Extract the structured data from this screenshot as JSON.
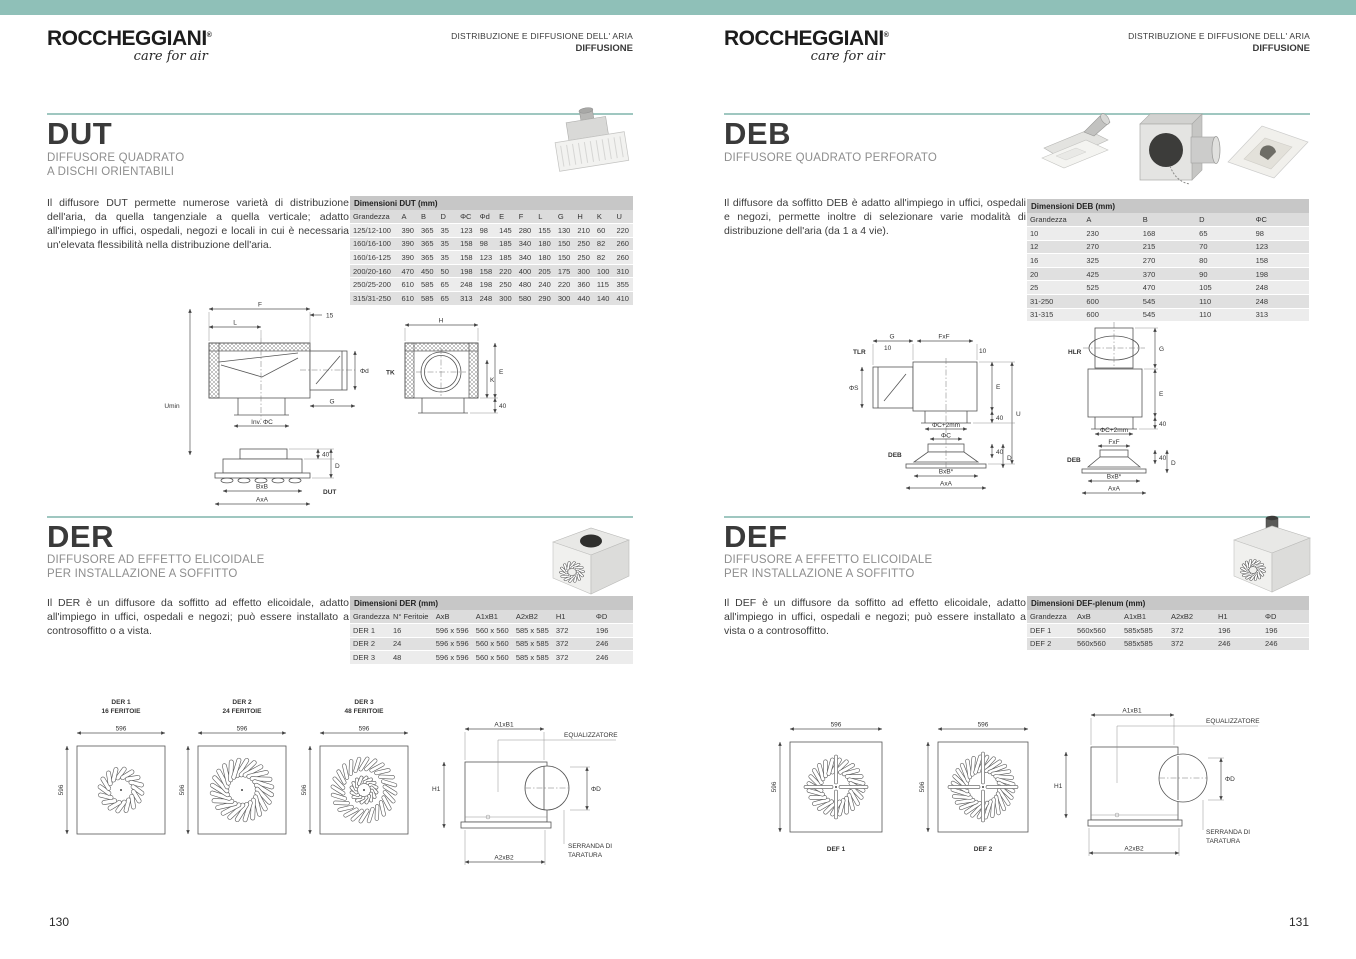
{
  "accent": {
    "band": "#8fc0b8",
    "divider": "#9fc7c0"
  },
  "header": {
    "brand": "ROCCHEGGIANI",
    "reg": "®",
    "tagline": "care for air",
    "line1": "DISTRIBUZIONE E DIFFUSIONE DELL' ARIA",
    "line2": "DIFFUSIONE"
  },
  "pages": {
    "left_number": "130",
    "right_number": "131"
  },
  "dut": {
    "title": "DUT",
    "subtitle1": "DIFFUSORE QUADRATO",
    "subtitle2": "A DISCHI ORIENTABILI",
    "description": "Il diffusore DUT permette numerose varietà di distribuzione dell'aria, da quella tangenziale a quella verticale; adatto all'impiego in uffici, ospedali, negozi e locali in cui è necessaria un'elevata flessibilità nella distribuzione dell'aria.",
    "table": {
      "title": "Dimensioni DUT (mm)",
      "columns": [
        "Grandezza",
        "A",
        "B",
        "D",
        "ΦC",
        "Φd",
        "E",
        "F",
        "L",
        "G",
        "H",
        "K",
        "U"
      ],
      "rows": [
        [
          "125/12-100",
          "390",
          "365",
          "35",
          "123",
          "98",
          "145",
          "280",
          "155",
          "130",
          "210",
          "60",
          "220"
        ],
        [
          "160/16-100",
          "390",
          "365",
          "35",
          "158",
          "98",
          "185",
          "340",
          "180",
          "150",
          "250",
          "82",
          "260"
        ],
        [
          "160/16-125",
          "390",
          "365",
          "35",
          "158",
          "123",
          "185",
          "340",
          "180",
          "150",
          "250",
          "82",
          "260"
        ],
        [
          "200/20-160",
          "470",
          "450",
          "50",
          "198",
          "158",
          "220",
          "400",
          "205",
          "175",
          "300",
          "100",
          "310"
        ],
        [
          "250/25-200",
          "610",
          "585",
          "65",
          "248",
          "198",
          "250",
          "480",
          "240",
          "220",
          "360",
          "115",
          "355"
        ],
        [
          "315/31-250",
          "610",
          "585",
          "65",
          "313",
          "248",
          "300",
          "580",
          "290",
          "300",
          "440",
          "140",
          "410"
        ]
      ]
    },
    "diagram": {
      "f": "F",
      "l": "L",
      "n15": "15",
      "umin": "Umin",
      "phid": "Φd",
      "g": "G",
      "inv": "Inv. ΦC",
      "h": "H",
      "tk": "TK",
      "e": "E",
      "k": "K",
      "n40": "40",
      "d": "D",
      "bxb": "BxB",
      "axa": "AxA",
      "name": "DUT"
    }
  },
  "deb": {
    "title": "DEB",
    "subtitle1": "DIFFUSORE QUADRATO PERFORATO",
    "description": "Il diffusore da soffitto DEB è adatto all'impiego in uffici, ospedali e negozi, permette inoltre di selezionare varie modalità di distribuzione dell'aria (da 1 a 4 vie).",
    "table": {
      "title": "Dimensioni DEB (mm)",
      "columns": [
        "Grandezza",
        "A",
        "B",
        "D",
        "ΦC"
      ],
      "rows": [
        [
          "10",
          "230",
          "168",
          "65",
          "98"
        ],
        [
          "12",
          "270",
          "215",
          "70",
          "123"
        ],
        [
          "16",
          "325",
          "270",
          "80",
          "158"
        ],
        [
          "20",
          "425",
          "370",
          "90",
          "198"
        ],
        [
          "25",
          "525",
          "470",
          "105",
          "248"
        ],
        [
          "31-250",
          "600",
          "545",
          "110",
          "248"
        ],
        [
          "31-315",
          "600",
          "545",
          "110",
          "313"
        ]
      ]
    },
    "diagram": {
      "tlr": "TLR",
      "hlr": "HLR",
      "g": "G",
      "n10": "10",
      "fxf": "FxF",
      "phis": "ΦS",
      "e": "E",
      "n40": "40",
      "u": "U",
      "phic2": "ΦC+2mm",
      "phic": "ΦC",
      "deb": "DEB",
      "d": "D",
      "bxb": "BxB*",
      "axa": "AxA"
    }
  },
  "der": {
    "title": "DER",
    "subtitle1": "DIFFUSORE AD EFFETTO ELICOIDALE",
    "subtitle2": "PER INSTALLAZIONE A SOFFITTO",
    "description": "Il DER è un diffusore da soffitto ad effetto elicoidale, adatto all'impiego in uffici, ospedali e negozi; può essere installato a controsoffitto o a vista.",
    "table": {
      "title": "Dimensioni DER (mm)",
      "columns": [
        "Grandezza",
        "N° Feritoie",
        "AxB",
        "A1xB1",
        "A2xB2",
        "H1",
        "ΦD"
      ],
      "rows": [
        [
          "DER 1",
          "16",
          "596 x 596",
          "560 x 560",
          "585 x 585",
          "372",
          "196"
        ],
        [
          "DER 2",
          "24",
          "596 x 596",
          "560 x 560",
          "585 x 585",
          "372",
          "246"
        ],
        [
          "DER 3",
          "48",
          "596 x 596",
          "560 x 560",
          "585 x 585",
          "372",
          "246"
        ]
      ]
    },
    "diagram": {
      "v1": "DER 1",
      "v1sub": "16 FERITOIE",
      "v2": "DER 2",
      "v2sub": "24 FERITOIE",
      "v3": "DER 3",
      "v3sub": "48 FERITOIE",
      "dim": "596",
      "h1": "H1",
      "a1b1": "A1xB1",
      "a2b2": "A2xB2",
      "phid": "ΦD",
      "eq": "EQUALIZZATORE",
      "ser1": "SERRANDA DI",
      "ser2": "TARATURA"
    }
  },
  "def": {
    "title": "DEF",
    "subtitle1": "DIFFUSORE A EFFETTO ELICOIDALE",
    "subtitle2": "PER INSTALLAZIONE A SOFFITTO",
    "description": "Il DEF è un diffusore da soffitto ad effetto elicoidale, adatto all'impiego in uffici, ospedali e negozi; può essere installato a vista o a controsoffitto.",
    "table": {
      "title": "Dimensioni DEF-plenum (mm)",
      "columns": [
        "Grandezza",
        "AxB",
        "A1xB1",
        "A2xB2",
        "H1",
        "ΦD"
      ],
      "rows": [
        [
          "DEF 1",
          "560x560",
          "585x585",
          "372",
          "196",
          "196"
        ],
        [
          "DEF 2",
          "560x560",
          "585x585",
          "372",
          "246",
          "246"
        ]
      ]
    },
    "diagram": {
      "v1": "DEF 1",
      "v2": "DEF 2",
      "dim": "596",
      "h1": "H1",
      "a1b1": "A1xB1",
      "a2b2": "A2xB2",
      "phid": "ΦD",
      "eq": "EQUALIZZATORE",
      "ser1": "SERRANDA DI",
      "ser2": "TARATURA"
    }
  }
}
